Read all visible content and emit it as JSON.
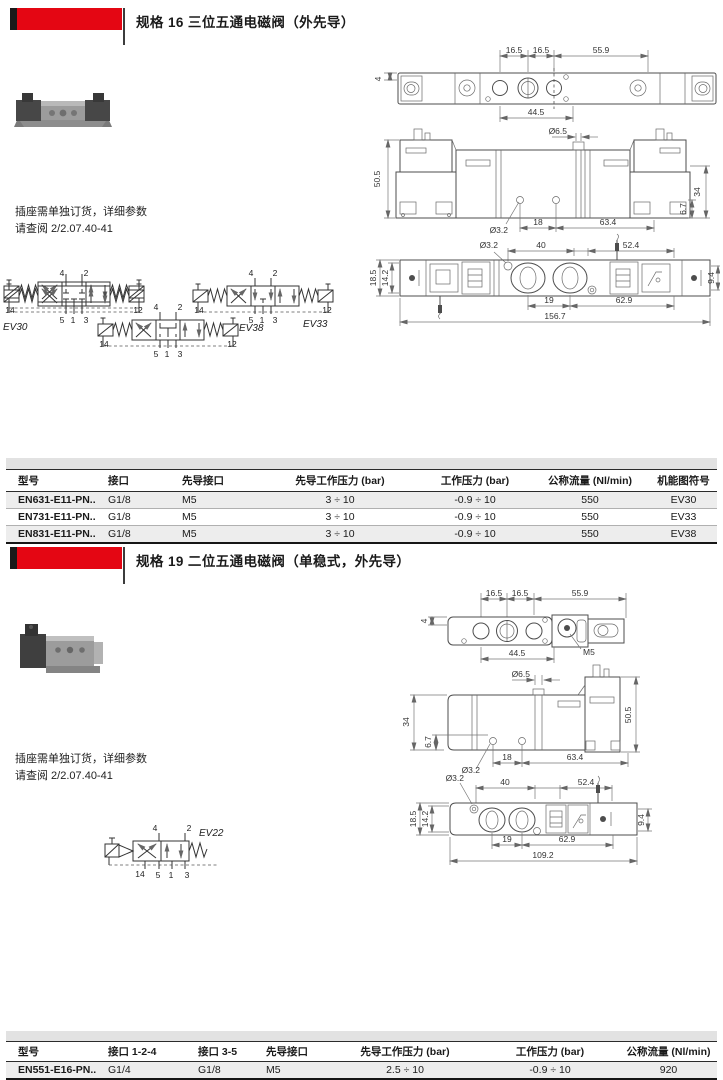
{
  "colors": {
    "accent_red": "#e40613",
    "band_gray": "#e2e2e2",
    "row_alt": "#ededed"
  },
  "sections": [
    {
      "title": "规格 16 三位五通电磁阀（外先导）",
      "note": [
        "插座需单独订货，详细参数",
        "请查阅 2/2.07.40-41"
      ],
      "drawings": {
        "top_view": {
          "dims_top": [
            "16.5",
            "16.5",
            "55.9"
          ],
          "dim_left": "4",
          "dim_bottom": "44.5"
        },
        "front_view": {
          "dim_top": "Ø6.5",
          "dim_left": "50.5",
          "dims_right": [
            "6.7",
            "34"
          ],
          "dims_bottom": [
            "Ø3.2",
            "18",
            "63.4"
          ]
        },
        "bottom_view": {
          "dims_top": [
            "Ø3.2",
            "40",
            "52.4"
          ],
          "dims_left": [
            "18.5",
            "14.2"
          ],
          "dim_right": "9.4",
          "dims_bottom": [
            "19",
            "62.9",
            "156.7"
          ]
        }
      },
      "circuits": [
        {
          "label": "EV30",
          "ports_top": [
            "4",
            "2"
          ],
          "ports_bottom": [
            "14",
            "5",
            "1",
            "3",
            "12"
          ]
        },
        {
          "label": "EV33",
          "ports_top": [
            "4",
            "2"
          ],
          "ports_bottom": [
            "14",
            "5",
            "1",
            "3",
            "12"
          ]
        },
        {
          "label": "EV38",
          "ports_top": [
            "4",
            "2"
          ],
          "ports_bottom": [
            "14",
            "5",
            "1",
            "3",
            "12"
          ]
        }
      ],
      "table": {
        "headers": [
          "型号",
          "接口",
          "先导接口",
          "先导工作压力 (bar)",
          "工作压力 (bar)",
          "公称流量 (Nl/min)",
          "机能图符号"
        ],
        "rows": [
          [
            "EN631-E11-PN..",
            "G1/8",
            "M5",
            "3 ÷ 10",
            "-0.9 ÷ 10",
            "550",
            "EV30"
          ],
          [
            "EN731-E11-PN..",
            "G1/8",
            "M5",
            "3 ÷ 10",
            "-0.9 ÷ 10",
            "550",
            "EV33"
          ],
          [
            "EN831-E11-PN..",
            "G1/8",
            "M5",
            "3 ÷ 10",
            "-0.9 ÷ 10",
            "550",
            "EV38"
          ]
        ]
      }
    },
    {
      "title": "规格 19 二位五通电磁阀（单稳式，外先导）",
      "note": [
        "插座需单独订货，详细参数",
        "请查阅 2/2.07.40-41"
      ],
      "drawings": {
        "top_view": {
          "dims_top": [
            "16.5",
            "16.5",
            "55.9"
          ],
          "dim_left": "4",
          "dim_bottom": "44.5",
          "thread_label": "M5"
        },
        "front_view": {
          "dim_top": "Ø6.5",
          "dims_left": [
            "34",
            "6.7"
          ],
          "dim_right": "50.5",
          "dims_bottom": [
            "Ø3.2",
            "18",
            "63.4"
          ]
        },
        "bottom_view": {
          "dims_top": [
            "Ø3.2",
            "40",
            "52.4"
          ],
          "dims_left": [
            "18.5",
            "14.2"
          ],
          "dim_right": "9.4",
          "dims_bottom": [
            "19",
            "62.9",
            "109.2"
          ]
        }
      },
      "circuits": [
        {
          "label": "EV22",
          "ports_top": [
            "4",
            "2"
          ],
          "ports_bottom": [
            "14",
            "5",
            "1",
            "3"
          ]
        }
      ],
      "table": {
        "headers": [
          "型号",
          "接口 1-2-4",
          "接口 3-5",
          "先导接口",
          "先导工作压力 (bar)",
          "工作压力 (bar)",
          "公称流量 (Nl/min)"
        ],
        "rows": [
          [
            "EN551-E16-PN..",
            "G1/4",
            "G1/8",
            "M5",
            "2.5 ÷ 10",
            "-0.9 ÷ 10",
            "920"
          ]
        ]
      }
    }
  ]
}
